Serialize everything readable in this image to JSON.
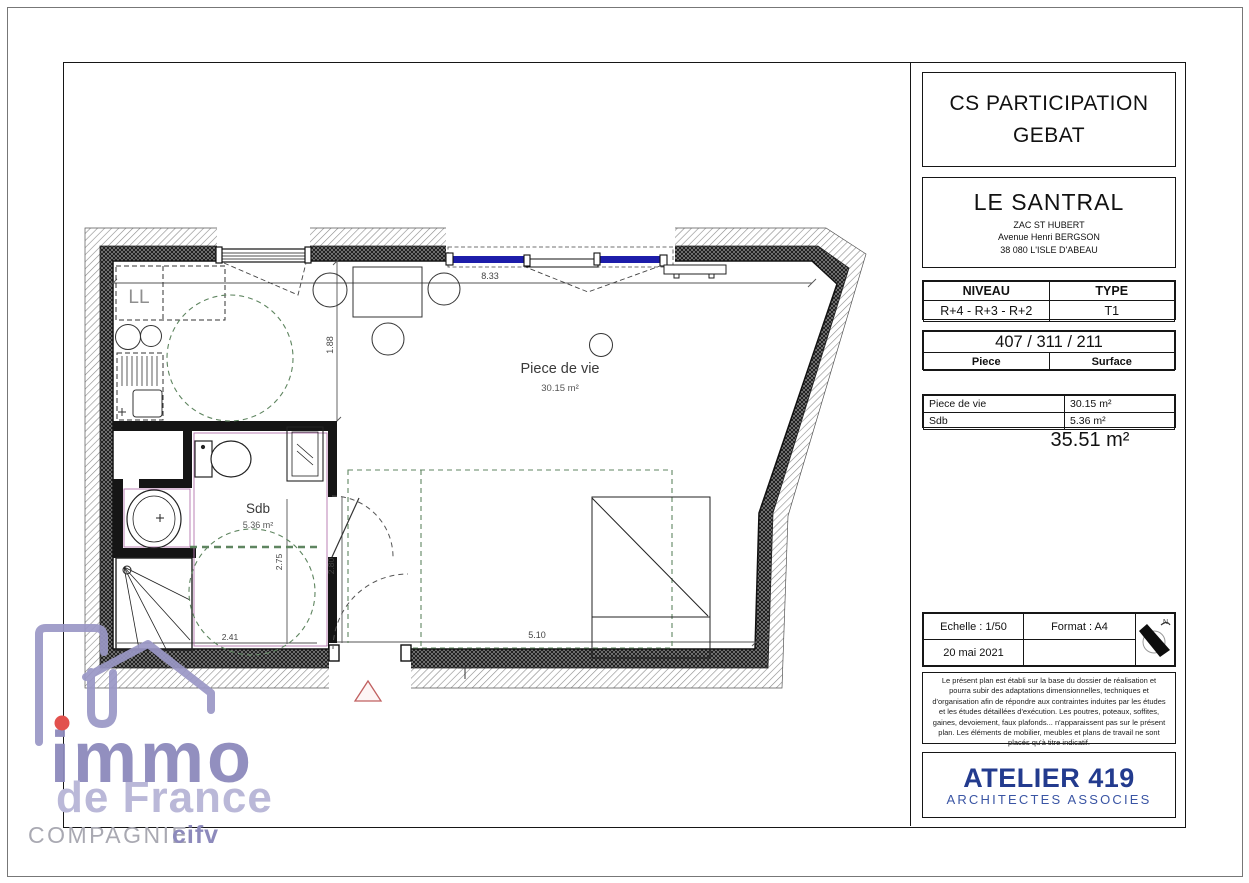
{
  "colors": {
    "wall_dark": "#3f3f3f",
    "window_blue": "#1d1daa",
    "accessibility_green": "#5f8560",
    "bathroom_magenta": "#b473ae",
    "entry_triangle_red": "#c06060",
    "architect_blue": "#233b8e",
    "logo_purple": "#8d8abc",
    "logo_light_purple": "#bab8d8",
    "logo_red_dot": "#e2514d"
  },
  "title_block": {
    "client": {
      "line1": "CS PARTICIPATION",
      "line2": "GEBAT"
    },
    "project": {
      "name": "LE SANTRAL",
      "address1": "ZAC ST HUBERT",
      "address2": "Avenue Henri BERGSON",
      "address3": "38 080 L'ISLE D'ABEAU"
    },
    "level_table": {
      "header_niveau": "NIVEAU",
      "header_type": "TYPE",
      "niveau": "R+4 - R+3 - R+2",
      "type": "T1"
    },
    "lot": {
      "numbers": "407 / 311 / 211",
      "col_piece": "Piece",
      "col_surface": "Surface"
    },
    "surfaces": {
      "rows": [
        [
          "Piece de vie",
          "30.15 m²"
        ],
        [
          "Sdb",
          "5.36 m²"
        ]
      ],
      "total": "35.51 m²"
    },
    "meta": {
      "echelle": "Echelle : 1/50",
      "format": "Format : A4",
      "date": "20 mai 2021",
      "north_letter": "N"
    },
    "disclaimer": "Le présent plan est établi sur la base du dossier de réalisation et pourra subir des adaptations dimensionnelles, techniques et d'organisation afin de répondre aux contraintes induites par les études et les études détaillées d'exécution. Les poutres, poteaux, soffites, gaines, devoiement, faux plafonds... n'apparaissent pas sur le présent plan. Les éléments de mobilier, meubles et plans de travail ne sont placés qu'à titre indicatif.",
    "architect": {
      "name": "ATELIER 419",
      "subtitle": "ARCHITECTES ASSOCIES"
    }
  },
  "plan": {
    "rooms": {
      "living": {
        "name": "Piece de vie",
        "area": "30.15 m²"
      },
      "bathroom": {
        "name": "Sdb",
        "area": "5.36 m²"
      },
      "washer_label": "LL"
    },
    "dimensions": {
      "top_width": "8.33",
      "kitchen_depth": "1.88",
      "bottom_width": "5.10",
      "sdb_height": "2.75",
      "door_wall": "2.80",
      "sdb_width": "2.41"
    }
  },
  "logo": {
    "immo": "immo",
    "de_france": "de France",
    "compagnie": "COMPAGNIE",
    "cifv": "cifv"
  }
}
